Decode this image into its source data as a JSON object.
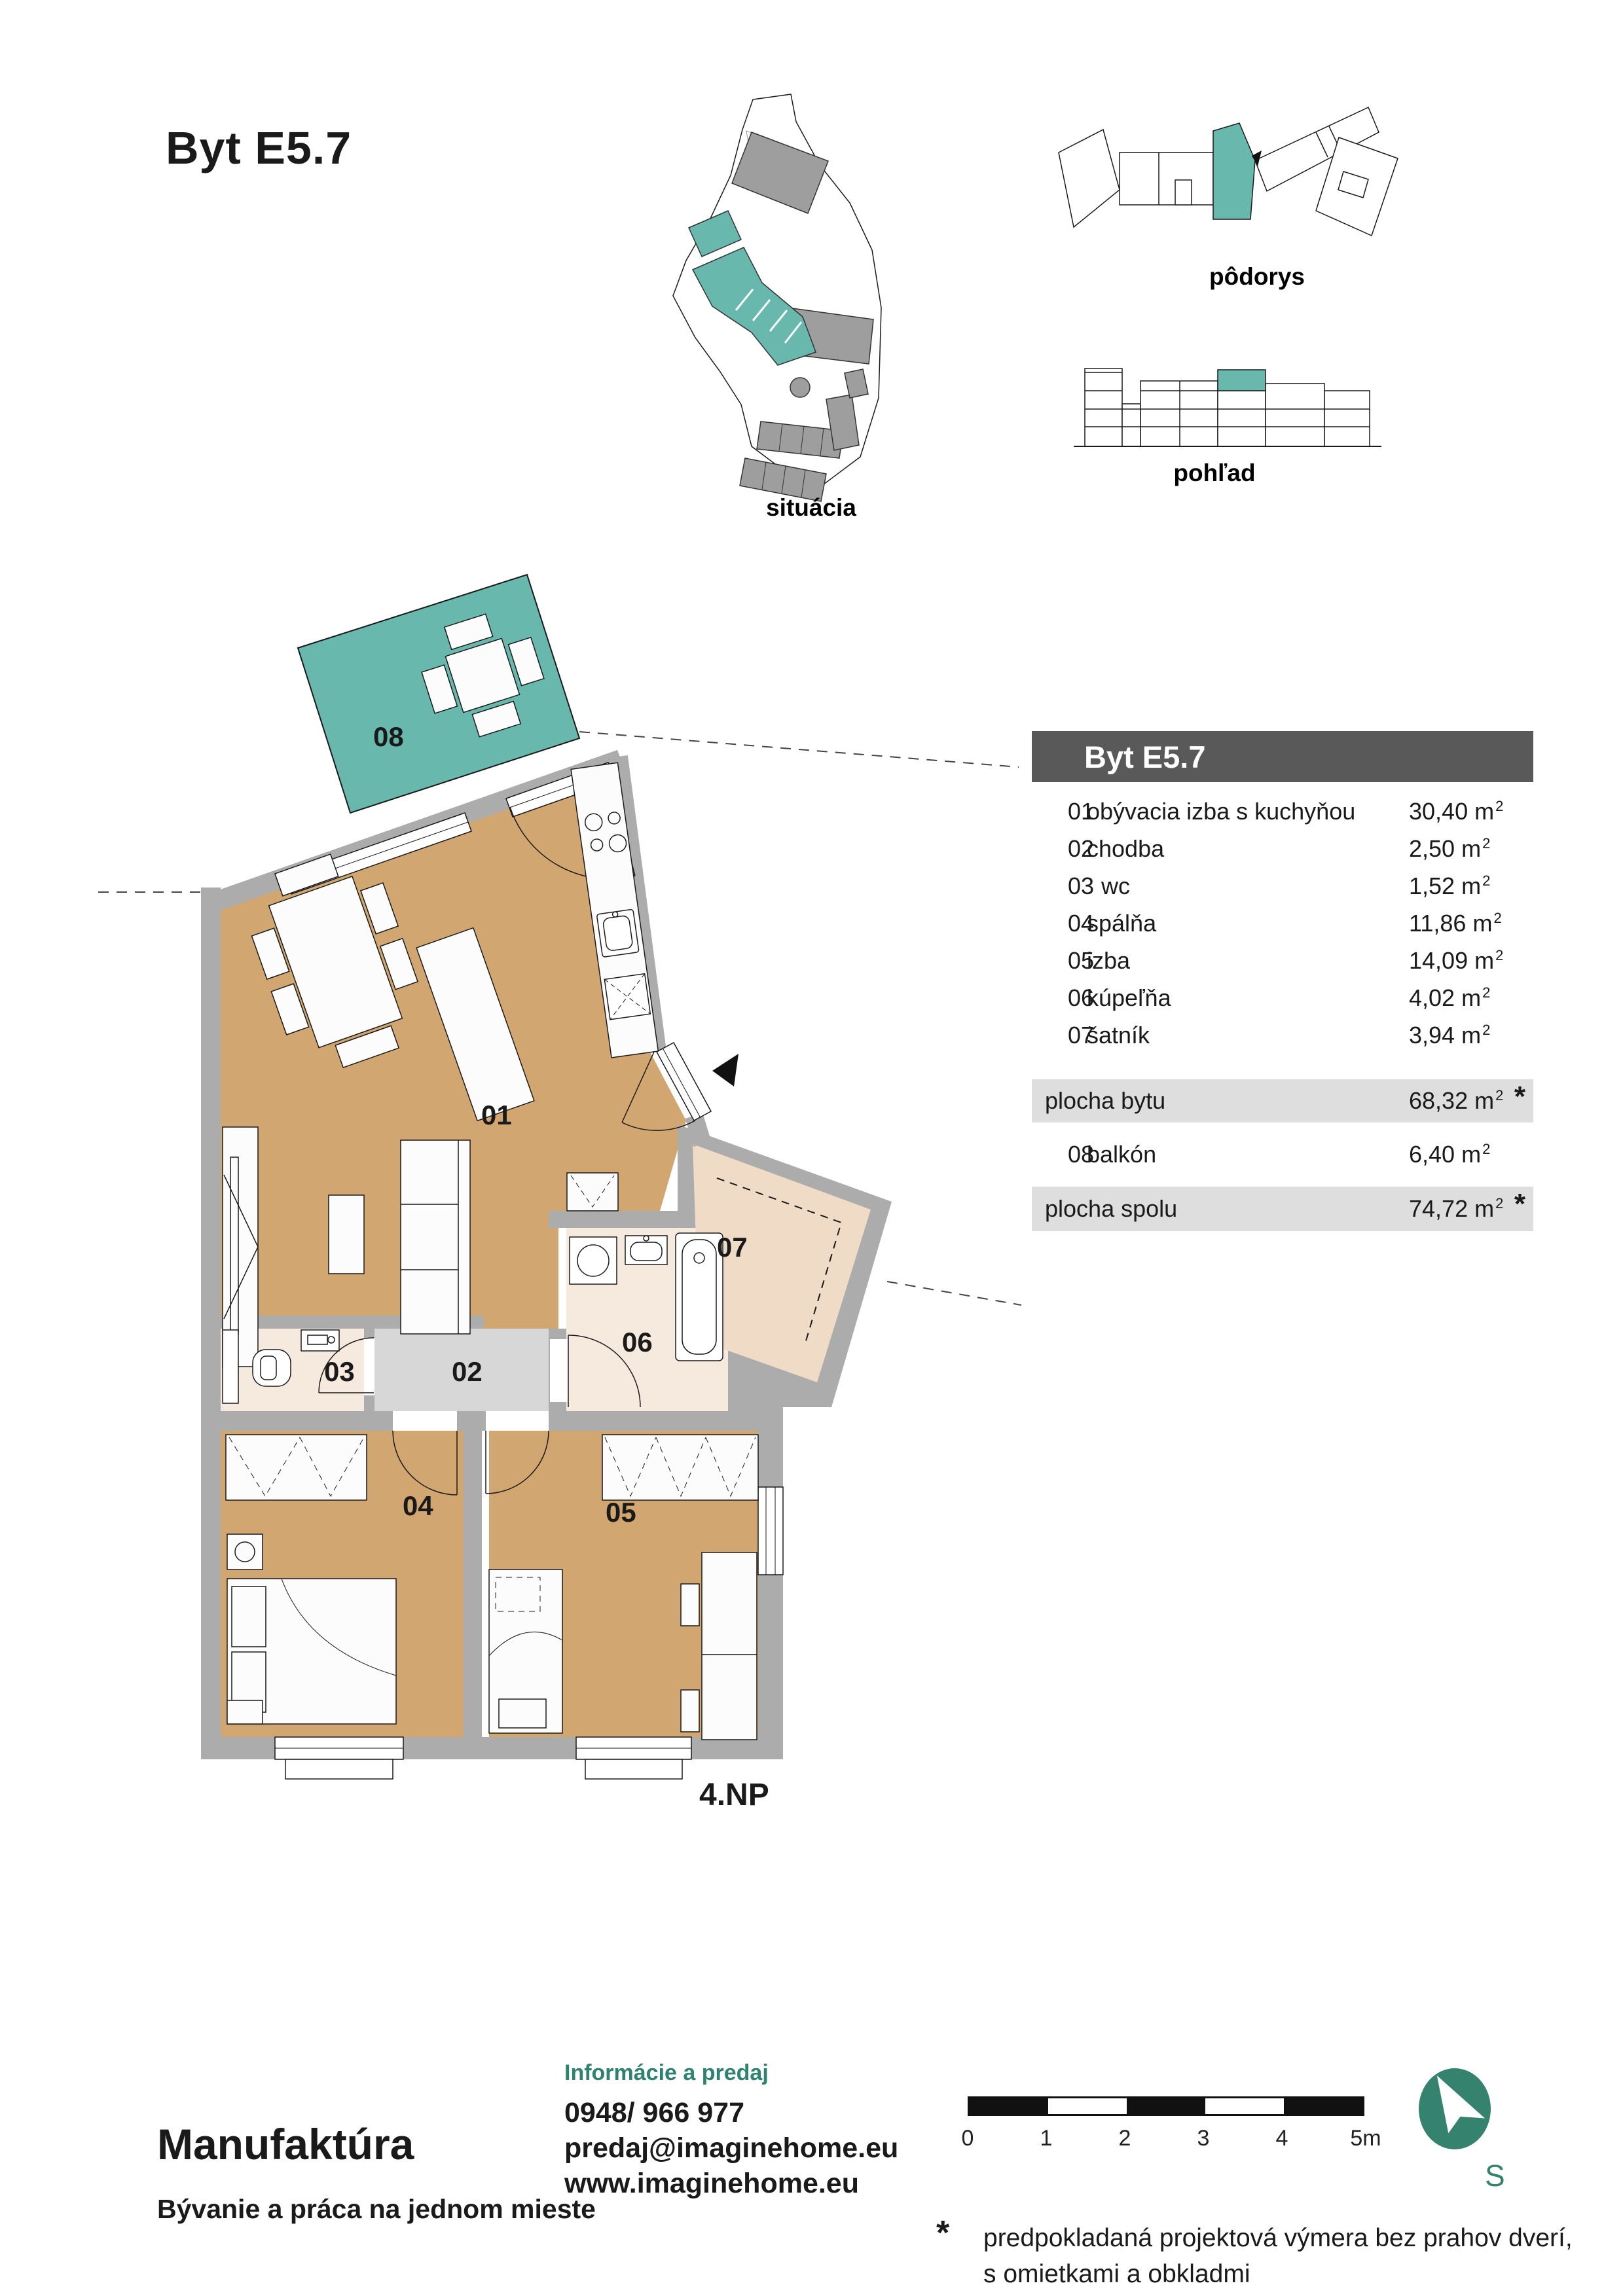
{
  "page": {
    "title": "Byt E5.7"
  },
  "diagrams": {
    "situacia_label": "situácia",
    "podorys_label": "pôdorys",
    "pohlad_label": "pohľad"
  },
  "plan": {
    "floor_label": "4.NP",
    "room_labels": {
      "r01": "01",
      "r02": "02",
      "r03": "03",
      "r04": "04",
      "r05": "05",
      "r06": "06",
      "r07": "07",
      "r08": "08"
    }
  },
  "table": {
    "header": "Byt E5.7",
    "unit": "m",
    "sup": "2",
    "asterisk": "*",
    "rooms": [
      {
        "no": "01",
        "name": "obývacia izba s kuchyňou",
        "area": "30,40"
      },
      {
        "no": "02",
        "name": "chodba",
        "area": "2,50"
      },
      {
        "no": "03",
        "name": "wc",
        "area": "1,52"
      },
      {
        "no": "04",
        "name": "spálňa",
        "area": "11,86"
      },
      {
        "no": "05",
        "name": "izba",
        "area": "14,09"
      },
      {
        "no": "06",
        "name": "kúpeľňa",
        "area": "4,02"
      },
      {
        "no": "07",
        "name": "šatník",
        "area": "3,94"
      }
    ],
    "summary_flat": {
      "label": "plocha bytu",
      "area": "68,32"
    },
    "balcony_row": {
      "no": "08",
      "name": "balkón",
      "area": "6,40"
    },
    "summary_total": {
      "label": "plocha spolu",
      "area": "74,72"
    }
  },
  "footer": {
    "brand": "Manufaktúra",
    "tagline": "Bývanie a práca na jednom mieste",
    "contact_heading": "Informácie a predaj",
    "phone": "0948/ 966 977",
    "email": "predaj@imaginehome.eu",
    "web": "www.imaginehome.eu",
    "scale_labels": [
      "0",
      "1",
      "2",
      "3",
      "4",
      "5m"
    ],
    "north_label": "S",
    "footnote_mark": "*",
    "footnote_line1": "predpokladaná projektová výmera bez prahov dverí,",
    "footnote_line2": "s omietkami a obkladmi"
  },
  "colors": {
    "teal": "#68B8AE",
    "teal_dark": "#2F8270",
    "floor_tan": "#D2A670",
    "floor_pale": "#F6E9DE",
    "floor_closet": "#F0DCC6",
    "floor_hall": "#D7D7D7",
    "wall_gray": "#ACACAC",
    "building_gray": "#9E9E9E",
    "header_gray": "#595959",
    "band_gray": "#DEDEDE"
  }
}
